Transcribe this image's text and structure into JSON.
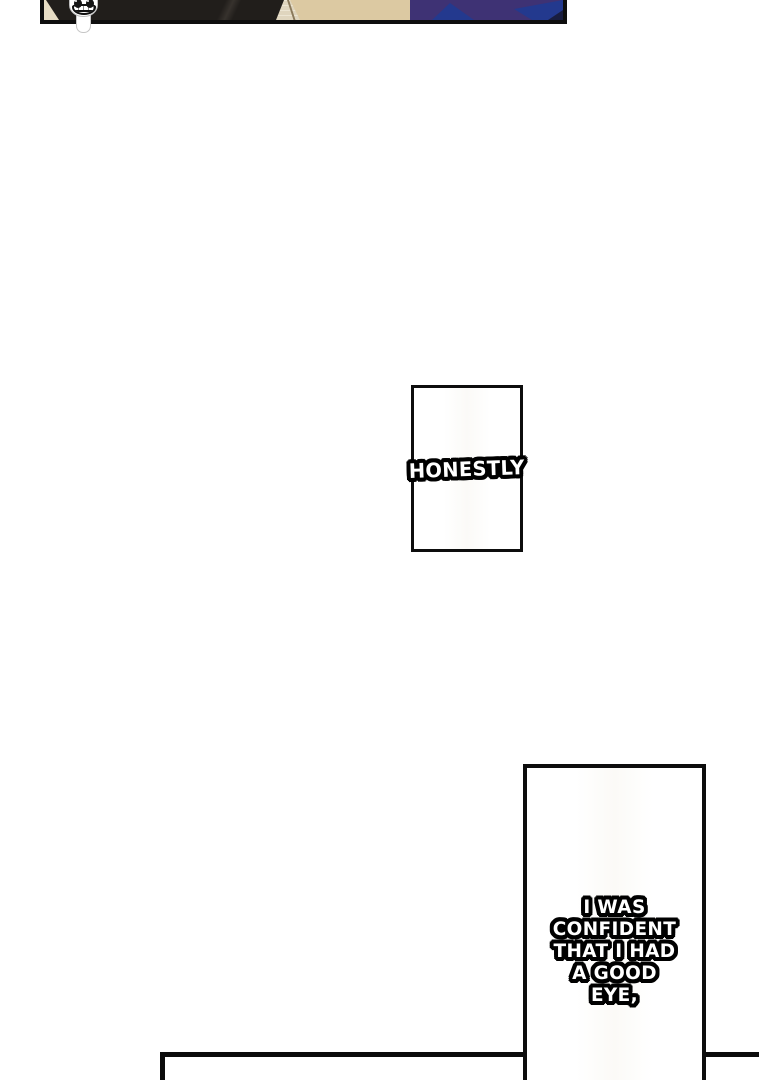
{
  "page": {
    "kind": "comic-page-strip",
    "background": "#ffffff"
  },
  "captions": {
    "honestly": {
      "text": "HONESTLY"
    },
    "confident": {
      "lines": [
        "I WAS",
        "CONFIDENT",
        "THAT I HAD",
        "A GOOD",
        "EYE,"
      ]
    }
  },
  "mascot": {
    "name": "grinning-mascot"
  },
  "colors": {
    "ink_black": "#0e0e0e",
    "hair_black": "#211e1b",
    "beige_light": "#e6dcc4",
    "beige_dark": "#dcc9a2",
    "fold_line_brown": "#8a795b",
    "clothes_purple": "#3e3274",
    "clothes_blue": "#23398e",
    "clothes_navy": "#191d3f",
    "text_fill": "#ffffff",
    "text_outline": "#000000"
  }
}
